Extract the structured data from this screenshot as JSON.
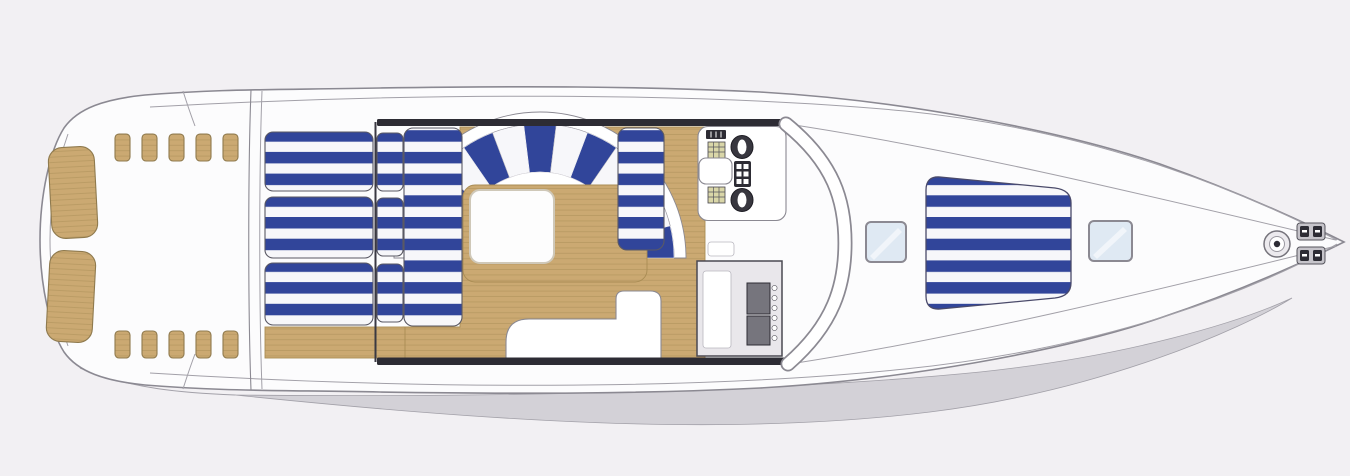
{
  "meta": {
    "title": "Motor yacht deck plan — flybridge and foredeck, top view",
    "orientation": "bow-right",
    "style": "architectural line drawing, no text labels"
  },
  "colors": {
    "background": "#f2f0f3",
    "hull_white": "#fcfcfd",
    "outline": "#8b8992",
    "deck_line": "#a2a0a8",
    "hull_shadow": "#d3d1d7",
    "teak": "#cba972",
    "teak_line": "#a98c54",
    "cushion_blue": "#31459a",
    "cushion_white": "#f7f7fa",
    "dark_trim": "#2d2c34",
    "seat_dark": "#38373f",
    "counter": "#e9e7eb",
    "grill": "#76757d",
    "panel_olive": "#d9d6a8",
    "hatch_glass": "#dfe9f3",
    "table_white": "#fdfdfd",
    "pad_outline": "#4a4a6a"
  },
  "stern": {
    "swim_platform_panels": 2,
    "step_pads_top": 5,
    "step_pads_bottom": 5,
    "material": "teak"
  },
  "aft_deck": {
    "sun_loungers": 3,
    "lounger_headrests": 3,
    "upholstery": "blue and white stripes"
  },
  "flybridge": {
    "teak_floor": true,
    "fan_seating": {
      "shape": "semicircular",
      "wedges": 13,
      "cx": 540,
      "cy": 258,
      "r_inner": 86,
      "r_outer": 134
    },
    "cocktail_table": 1,
    "side_bench_arms": 2,
    "helm": {
      "seats": 2,
      "companion_console": 1,
      "instrument_panels": 3,
      "helm_seat_white": 1
    },
    "wet_bar": {
      "sink": 1,
      "grill_modules": 2,
      "control_knobs": 6
    },
    "companionway_steps": 1
  },
  "foredeck": {
    "deck_hatches": 2,
    "sunpad": {
      "count": 1,
      "blue_stripes": 6
    }
  },
  "bow": {
    "anchor_windlass": 1,
    "mooring_cleat_plates": 2
  }
}
